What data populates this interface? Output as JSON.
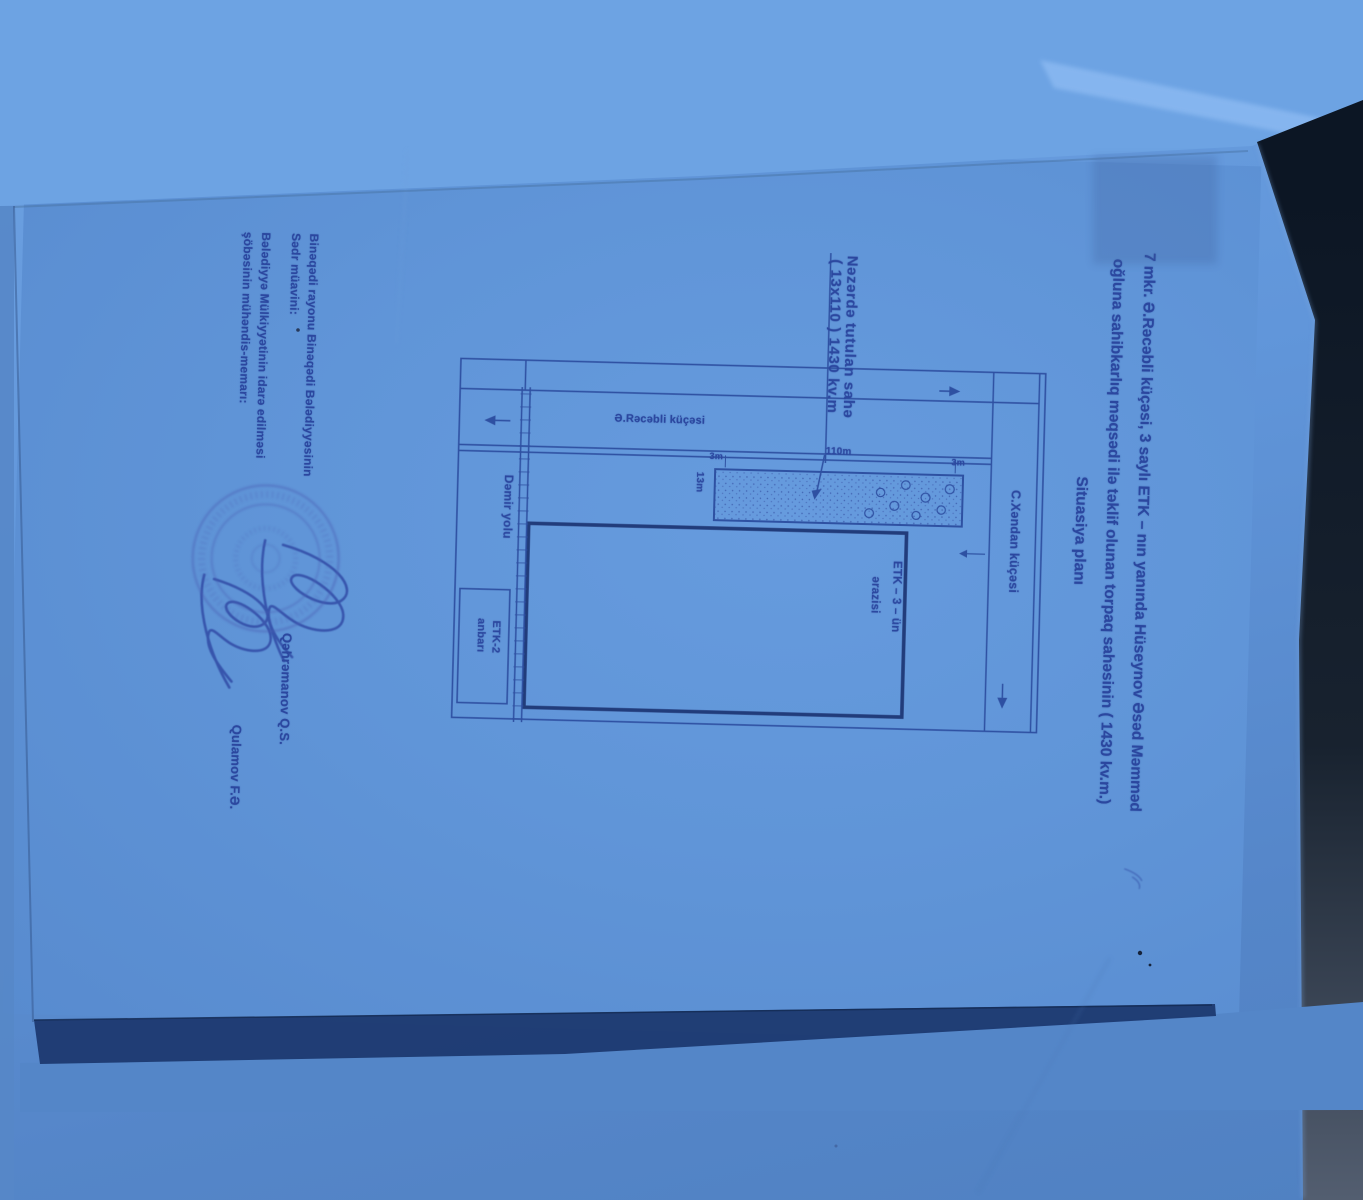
{
  "document": {
    "title": {
      "line1": "7 mkr. Ə.Rəcəbli küçəsi, 3 saylı ETK – nın yanında Hüseynov Əsəd Məmməd",
      "line2": "oğluna sahibkarlıq məqsədi ilə təklif olunan torpaq sahəsinin ( 1430 kv.m.)",
      "line3": "Situasiya planı"
    },
    "plan": {
      "note": {
        "line1": "Nəzərdə tutulan sahə",
        "line2": "( 13x110 ) 1430 kv.m"
      },
      "streets": {
        "racabli": "Ə.Rəcəbli küçəsi",
        "xandan": "C.Xəndan küçəsi"
      },
      "railway": "Dəmir yolu",
      "etk2": {
        "line1": "ETK-2",
        "line2": "anbarı"
      },
      "etk3": {
        "line1": "ETK – 3 – ün",
        "line2": "ərazisi"
      },
      "dimensions": {
        "long_side": "110m",
        "short_side": "13m",
        "gap_top": "3m",
        "gap_bottom": "3m"
      }
    },
    "signoff": {
      "org_line1": "Binəqədi rayonu Binəqədi Bələdiyyəsinin",
      "role1": "Sədr müavini:",
      "name1": "Qəhrəmanov Q.S.",
      "org_line2": "Bələdiyyə Mülkiyyətinin idarə edilməsi",
      "role2": "şöbəsinin  mühəndis-memarı:",
      "name2": "Qulamov F.Ə."
    }
  },
  "colors": {
    "paper": "#6095d8",
    "ink": "#2b479f",
    "drawing_line": "#2c4b9e",
    "dark_background": "#0d1726",
    "paper_edge_shadow": "#1e3b72",
    "stamp": "#4b5fb5"
  }
}
